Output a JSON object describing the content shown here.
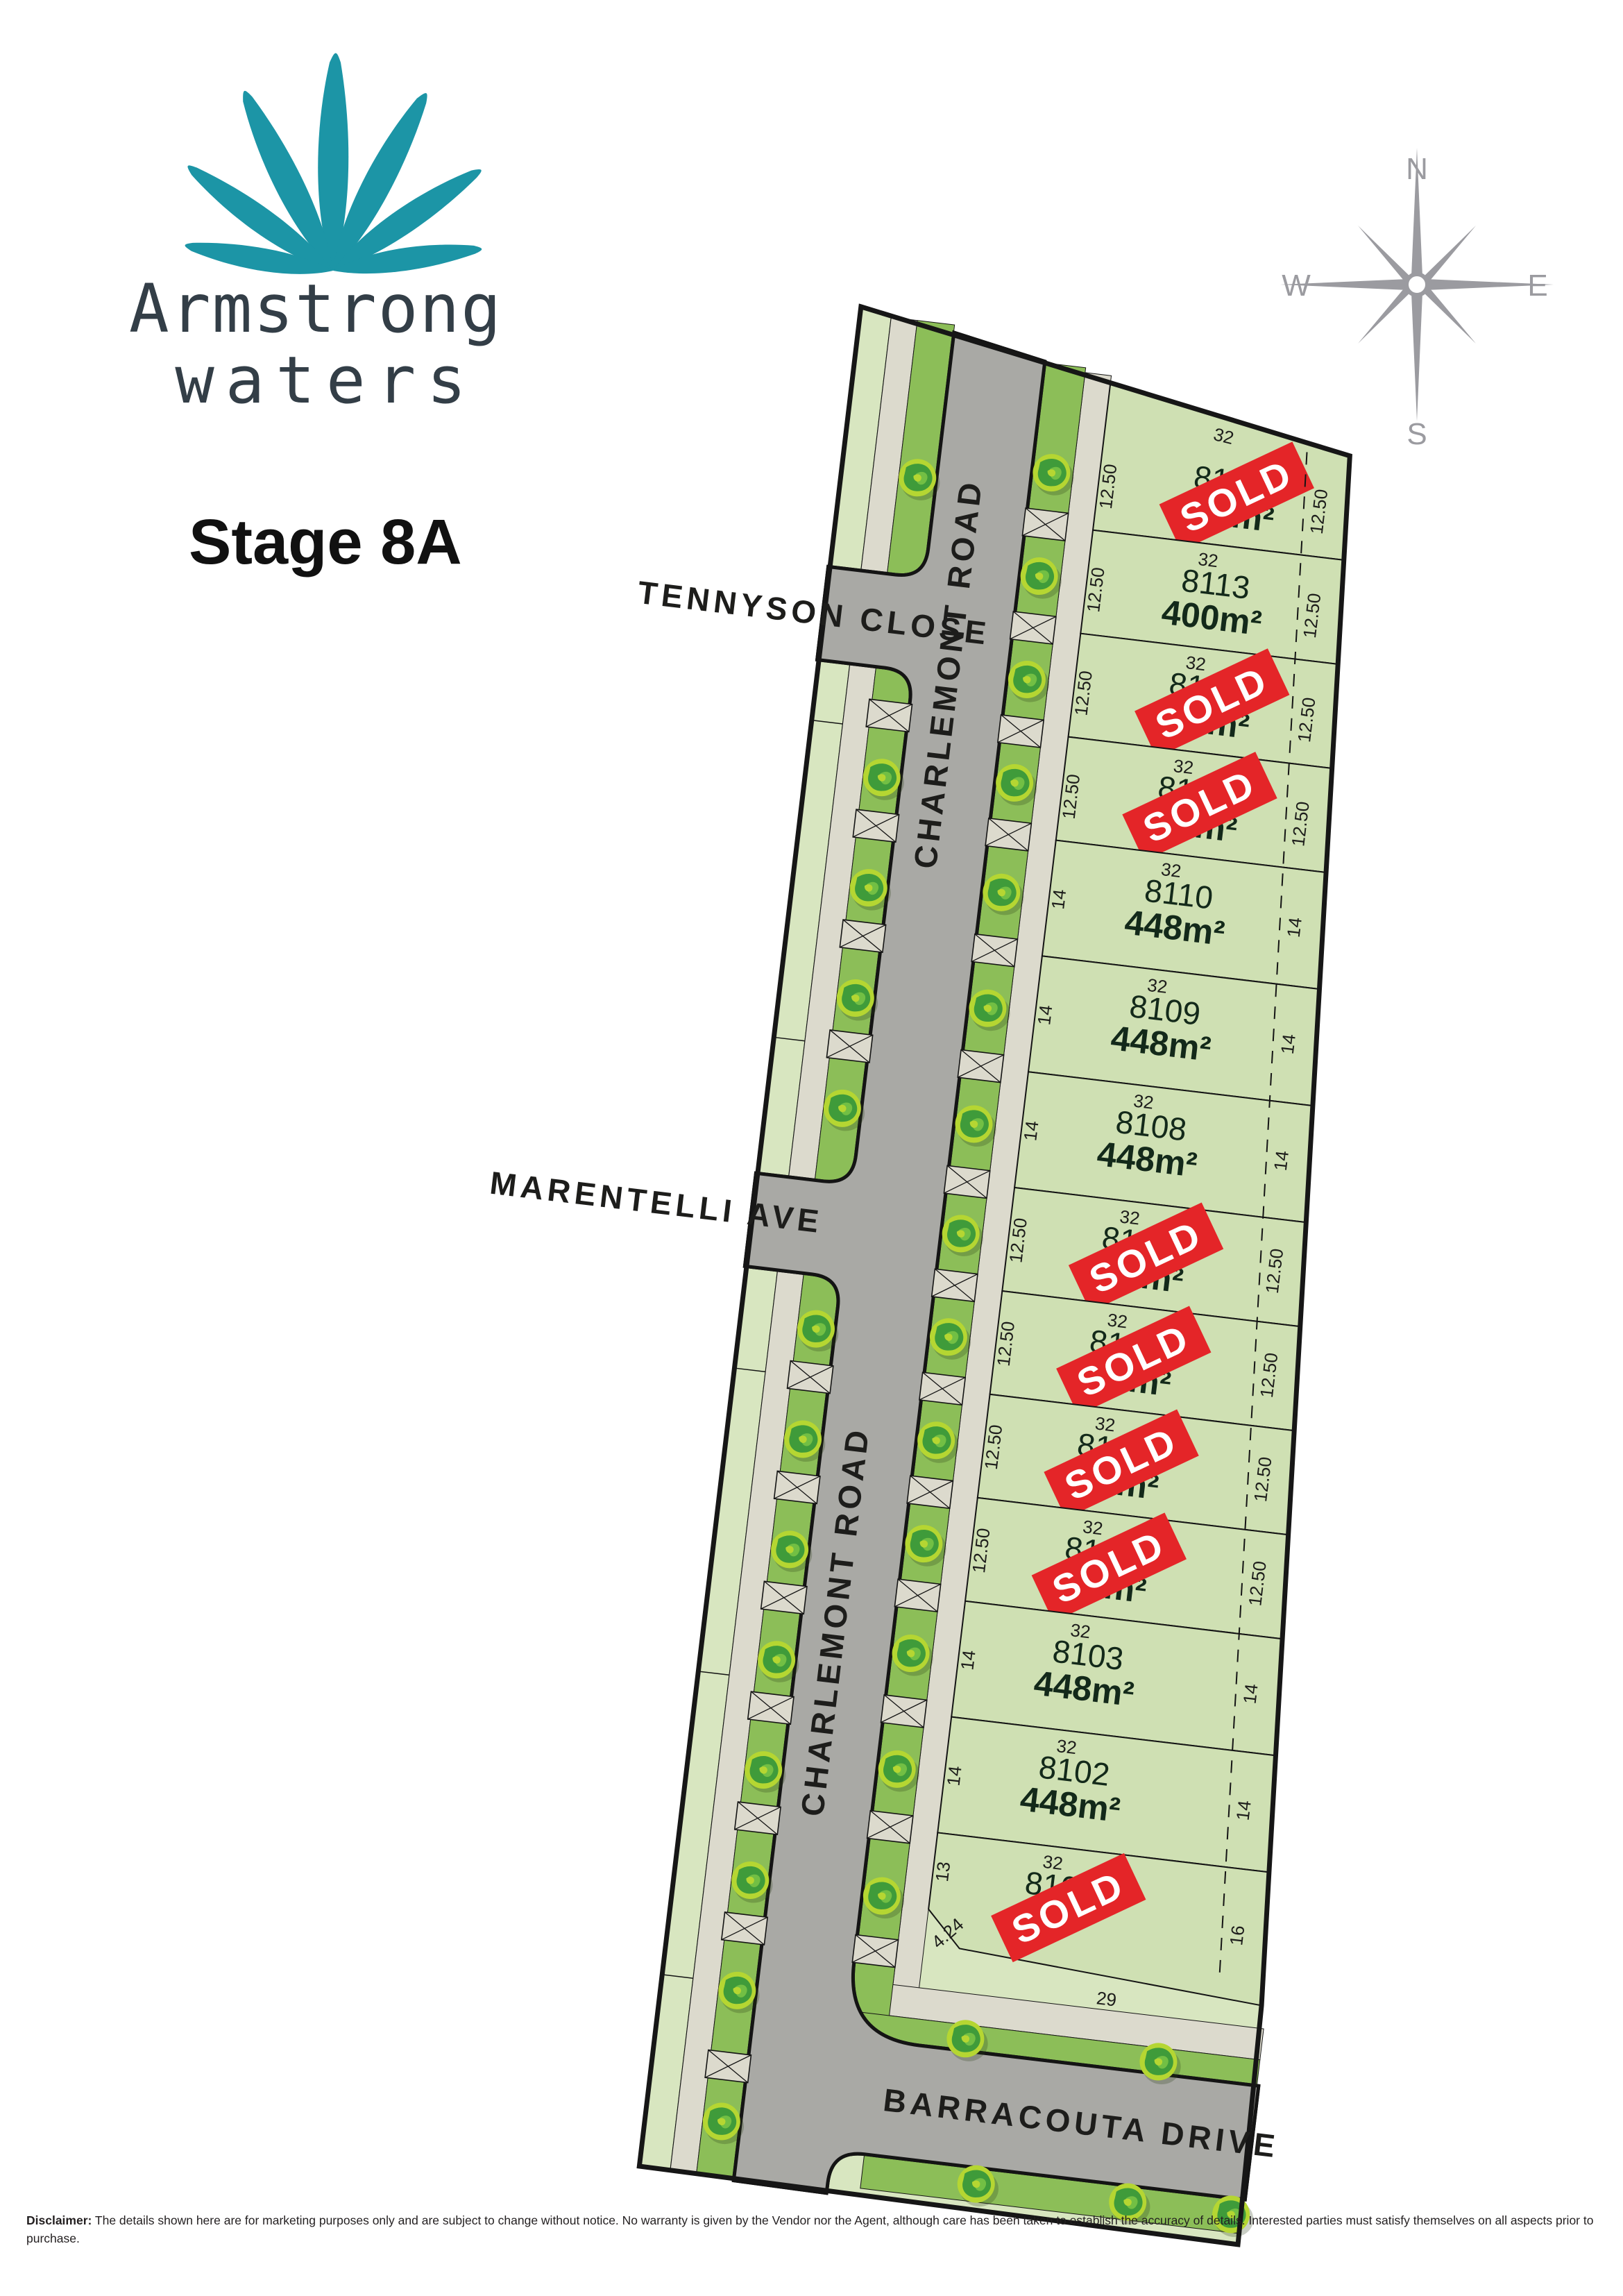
{
  "brand": {
    "name_line1": "Armstrong",
    "name_line2": "waters",
    "stage": "Stage 8A"
  },
  "compass": {
    "north": "N",
    "south": "S",
    "east": "E",
    "west": "W"
  },
  "streets": {
    "tennyson": "TENNYSON CLOSE",
    "marentelli": "MARENTELLI AVE",
    "charlemont": "CHARLEMONT  ROAD",
    "barracouta": "BARRACOUTA  DRIVE"
  },
  "labels": {
    "sold": "SOLD"
  },
  "lots": [
    {
      "id": "8114",
      "area": "400m²",
      "width": "32",
      "left": "12.50",
      "right": "12.50",
      "status": "sold"
    },
    {
      "id": "8113",
      "area": "400m²",
      "width": "32",
      "left": "12.50",
      "right": "12.50",
      "status": "available"
    },
    {
      "id": "8112",
      "area": "400m²",
      "width": "32",
      "left": "12.50",
      "right": "12.50",
      "status": "sold"
    },
    {
      "id": "8111",
      "area": "400m²",
      "width": "32",
      "left": "12.50",
      "right": "12.50",
      "status": "sold"
    },
    {
      "id": "8110",
      "area": "448m²",
      "width": "32",
      "left": "14",
      "right": "14",
      "status": "available"
    },
    {
      "id": "8109",
      "area": "448m²",
      "width": "32",
      "left": "14",
      "right": "14",
      "status": "available"
    },
    {
      "id": "8108",
      "area": "448m²",
      "width": "32",
      "left": "14",
      "right": "14",
      "status": "available"
    },
    {
      "id": "8107",
      "area": "400m²",
      "width": "32",
      "left": "12.50",
      "right": "12.50",
      "status": "sold"
    },
    {
      "id": "8106",
      "area": "400m²",
      "width": "32",
      "left": "12.50",
      "right": "12.50",
      "status": "sold"
    },
    {
      "id": "8105",
      "area": "400m²",
      "width": "32",
      "left": "12.50",
      "right": "12.50",
      "status": "sold"
    },
    {
      "id": "8104",
      "area": "400m²",
      "width": "32",
      "left": "12.50",
      "right": "12.50",
      "status": "sold"
    },
    {
      "id": "8103",
      "area": "448m²",
      "width": "32",
      "left": "14",
      "right": "14",
      "status": "available"
    },
    {
      "id": "8102",
      "area": "448m²",
      "width": "32",
      "left": "14",
      "right": "14",
      "status": "available"
    },
    {
      "id": "8101",
      "area": "m²",
      "width": "32",
      "left": "13",
      "right": "16",
      "bottom": "29",
      "splay": "4.24",
      "status": "sold"
    }
  ],
  "disclaimer": {
    "title": "Disclaimer:",
    "text": " The details shown here are for marketing purposes only and are subject to change without notice. No warranty is given by the Vendor nor the Agent, although care has been taken to establish the accuracy of details. Interested parties must satisfy themselves on all aspects prior to purchase."
  },
  "colors": {
    "teal": "#1c95a6",
    "navy": "#333e47",
    "sold_red": "#e42528",
    "road_gray": "#a9a9a5",
    "lot_green": "#cfe0b3",
    "base_green": "#d8e6c0",
    "verge_green": "#8cbe58",
    "footpath_beige": "#dcdacd",
    "outline": "#161616",
    "compass_gray": "#9b9ba0"
  }
}
